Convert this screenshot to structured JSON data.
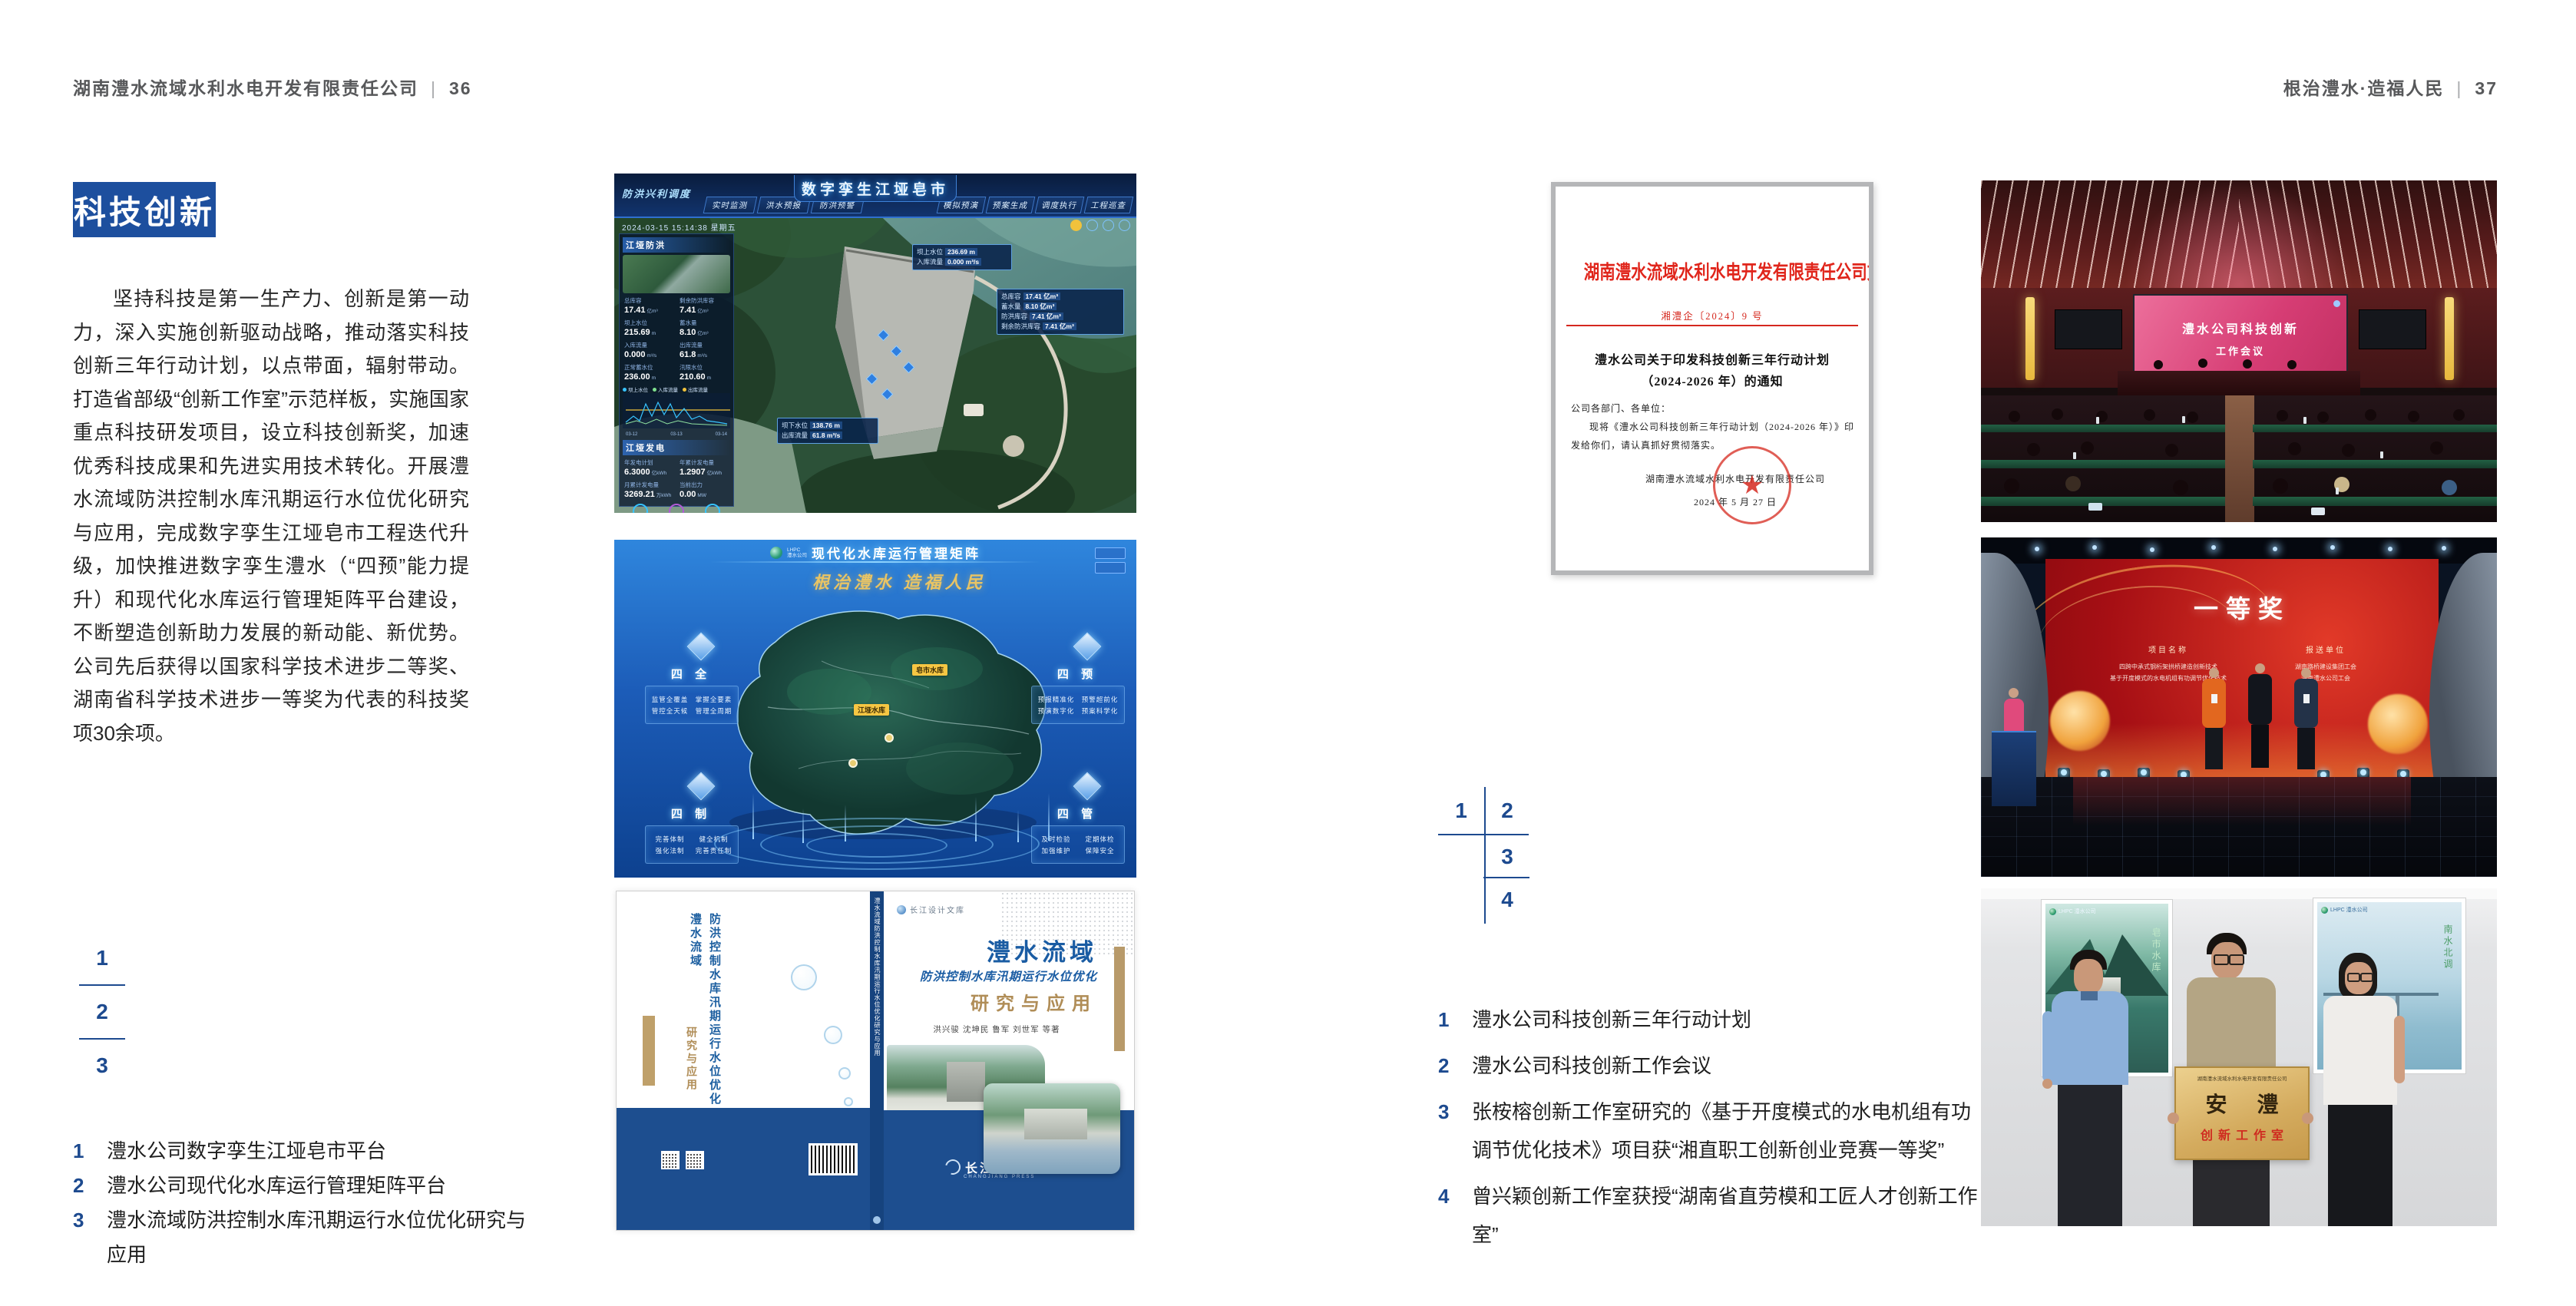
{
  "colors": {
    "accent_blue": "#1d4f9e",
    "number_blue": "#1d4a8f",
    "doc_red": "#d5281e",
    "gold": "#e9c464"
  },
  "left": {
    "header": {
      "company": "湖南澧水流域水利水电开发有限责任公司",
      "divider": "|",
      "page": "36"
    },
    "section_title": "科技创新",
    "body": "坚持科技是第一生产力、创新是第一动力，深入实施创新驱动战略，推动落实科技创新三年行动计划，以点带面，辐射带动。打造省部级“创新工作室”示范样板，实施国家重点科技研发项目，设立科技创新奖，加速优秀科技成果和先进实用技术转化。开展澧水流域防洪控制水库汛期运行水位优化研究与应用，完成数字孪生江垭皂市工程迭代升级，加快推进数字孪生澧水（“四预”能力提升）和现代化水库运行管理矩阵平台建设，不断塑造创新助力发展的新动能、新优势。公司先后获得以国家科学技术进步二等奖、湖南省科学技术进步一等奖为代表的科技奖项30余项。",
    "figure_index": [
      "1",
      "2",
      "3"
    ],
    "captions": [
      {
        "n": "1",
        "t": "澧水公司数字孪生江垭皂市平台"
      },
      {
        "n": "2",
        "t": "澧水公司现代化水库运行管理矩阵平台"
      },
      {
        "n": "3",
        "t": "澧水流域防洪控制水库汛期运行水位优化研究与应用"
      }
    ]
  },
  "dashboard": {
    "title": "数字孪生江垭皂市",
    "corner_label": "防洪兴利调度",
    "tabs_left": [
      "实时监测",
      "洪水预报",
      "防洪预警"
    ],
    "tabs_right": [
      "模拟预演",
      "预案生成",
      "调度执行",
      "工程巡查"
    ],
    "timestamp": "2024-03-15 15:14:38 星期五",
    "p1": {
      "title": "江垭防洪",
      "stats": [
        {
          "l": "总库容",
          "v": "17.41",
          "u": "亿m³"
        },
        {
          "l": "剩余防洪库容",
          "v": "7.41",
          "u": "亿m³"
        },
        {
          "l": "坝上水位",
          "v": "215.69",
          "u": "m"
        },
        {
          "l": "蓄水量",
          "v": "8.10",
          "u": "亿m³"
        },
        {
          "l": "入库流量",
          "v": "0.000",
          "u": "m³/s"
        },
        {
          "l": "出库流量",
          "v": "61.8",
          "u": "m³/s"
        },
        {
          "l": "正常蓄水位",
          "v": "236.00",
          "u": "m"
        },
        {
          "l": "汛限水位",
          "v": "210.60",
          "u": "m"
        }
      ]
    },
    "legend": [
      "坝上水位",
      "入库流量",
      "出库流量"
    ],
    "xticks": [
      "03-12",
      "03-13",
      "03-14"
    ],
    "p2": {
      "title": "江垭发电",
      "stats": [
        {
          "l": "年发电计划",
          "v": "6.3000",
          "u": "亿kWh"
        },
        {
          "l": "年累计发电量",
          "v": "1.2907",
          "u": "亿kWh"
        },
        {
          "l": "月累计发电量",
          "v": "3269.21",
          "u": "万kWh"
        },
        {
          "l": "当前出力",
          "v": "0.00",
          "u": "MW"
        }
      ]
    },
    "callout1": [
      {
        "l": "坝上水位",
        "v": "236.69 m"
      },
      {
        "l": "入库流量",
        "v": "0.000 m³/s"
      }
    ],
    "callout2": [
      {
        "l": "总库容",
        "v": "17.41 亿m³"
      },
      {
        "l": "蓄水量",
        "v": "8.10 亿m³"
      },
      {
        "l": "防洪库容",
        "v": "7.41 亿m³"
      },
      {
        "l": "剩余防洪库容",
        "v": "7.41 亿m³"
      }
    ],
    "callout3": [
      {
        "l": "坝下水位",
        "v": "138.76 m"
      },
      {
        "l": "出库流量",
        "v": "61.8 m³/s"
      }
    ]
  },
  "matrix": {
    "brand_top": "LHPC",
    "brand_bottom": "澧水公司",
    "title": "现代化水库运行管理矩阵",
    "slogan": "根治澧水  造福人民",
    "groups": [
      {
        "title": "四 全",
        "items": [
          "监管全覆盖",
          "掌握全要素",
          "管控全天候",
          "管理全周期"
        ]
      },
      {
        "title": "四 预",
        "items": [
          "预报精准化",
          "预警超前化",
          "预演数字化",
          "预案科学化"
        ]
      },
      {
        "title": "四 制",
        "items": [
          "完善体制",
          "健全机制",
          "强化法制",
          "完善责任制"
        ]
      },
      {
        "title": "四 管",
        "items": [
          "及时检验",
          "定期体检",
          "加强维护",
          "保障安全"
        ]
      }
    ],
    "tags": [
      "皂市水库",
      "江垭水库"
    ]
  },
  "book": {
    "series": "长江设计文库",
    "back_title_a": "澧水流域",
    "back_title_b": "防洪控制水库汛期运行水位优化",
    "back_title_c": "研究与应用",
    "spine": "澧水流域防洪控制水库汛期运行水位优化研究与应用",
    "title_main": "澧水流域",
    "title_sub": "防洪控制水库汛期运行水位优化",
    "title_tail": "研究与应用",
    "authors": "洪兴骏  沈坤民  鲁军  刘世军  等著",
    "publisher": "长江出版社",
    "publisher_en": "CHANGJIANG PRESS"
  },
  "right": {
    "header": {
      "title": "根治澧水·造福人民",
      "divider": "|",
      "page": "37"
    },
    "figure_grid": [
      "1",
      "2",
      "3",
      "4"
    ],
    "captions": [
      {
        "n": "1",
        "t": "澧水公司科技创新三年行动计划"
      },
      {
        "n": "2",
        "t": "澧水公司科技创新工作会议"
      },
      {
        "n": "3",
        "t": "张桉榕创新工作室研究的《基于开度模式的水电机组有功调节优化技术》项目获“湘直职工创新创业竞赛一等奖”"
      },
      {
        "n": "4",
        "t": "曾兴颖创新工作室获授“湖南省直劳模和工匠人才创新工作室”"
      }
    ]
  },
  "document": {
    "header": "湖南澧水流域水利水电开发有限责任公司文件",
    "doc_no": "湘澧企〔2024〕9 号",
    "title_l1": "澧水公司关于印发科技创新三年行动计划",
    "title_l2": "（2024-2026 年）的通知",
    "salutation": "公司各部门、各单位：",
    "body_l1": "现将《澧水公司科技创新三年行动计划（2024-2026 年）》印",
    "body_l2": "发给你们，请认真抓好贯彻落实。",
    "signer": "湖南澧水流域水利水电开发有限责任公司",
    "date": "2024 年 5 月 27 日",
    "seal_star": "★"
  },
  "meeting": {
    "screen_l1": "澧水公司科技创新",
    "screen_l2": "工作会议"
  },
  "award": {
    "title": "一等奖",
    "col1": "项目名称",
    "col2": "报送单位",
    "p1": "四跨中承式钢桁架拱桥建造创新技术",
    "p2": "基于开度模式的水电机组有功调节优化技术",
    "u1": "湖南路桥建设集团工会",
    "u2": "湖南澧水公司工会"
  },
  "plaque": {
    "poster1_brand": "LHPC 澧水公司",
    "poster1_cap": "皂市水库",
    "poster2_brand": "LHPC 澧水公司",
    "poster2_cap": "南水北调",
    "header": "湖南澧水流域水利水电开发有限责任公司",
    "main": "安  澧",
    "sub": "创新工作室"
  }
}
